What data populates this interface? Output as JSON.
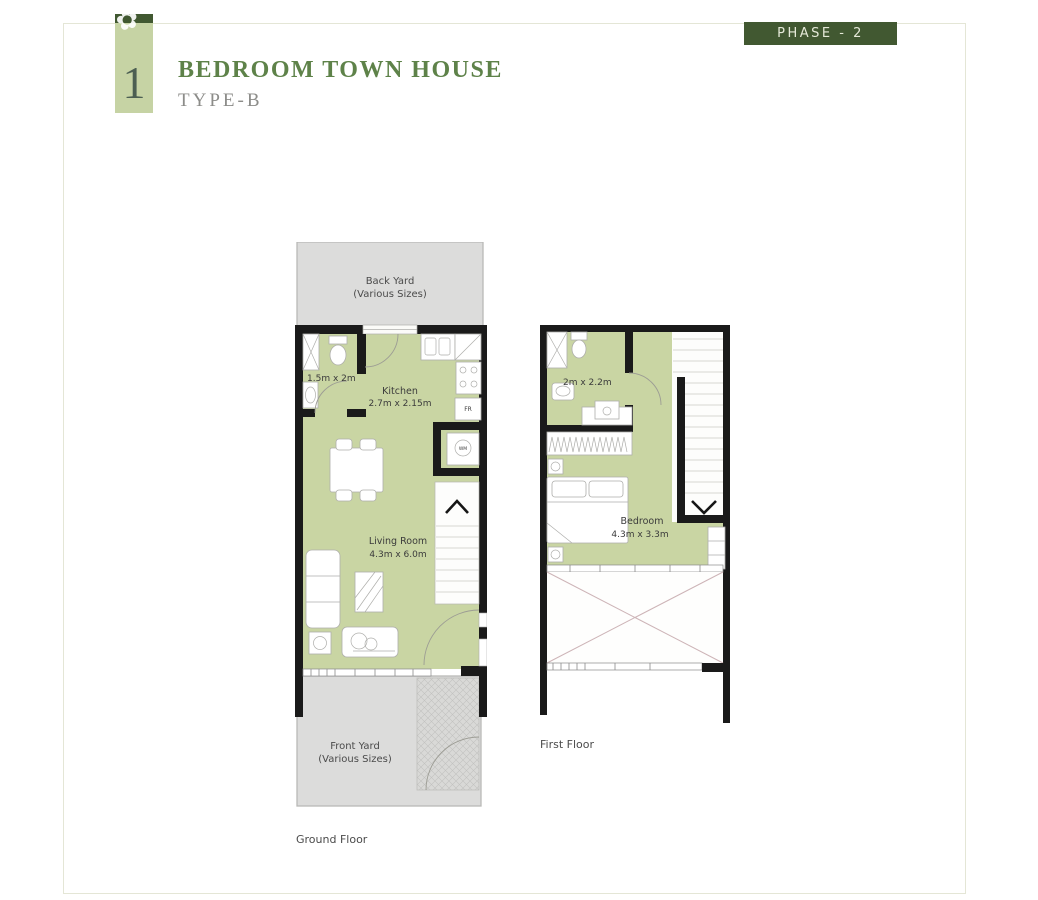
{
  "header": {
    "badge_number": "1",
    "title": "BEDROOM TOWN HOUSE",
    "subtitle": "TYPE-B",
    "phase_label": "PHASE - 2"
  },
  "ground_floor": {
    "caption": "Ground Floor",
    "back_yard_line1": "Back Yard",
    "back_yard_line2": "(Various Sizes)",
    "front_yard_line1": "Front Yard",
    "front_yard_line2": "(Various Sizes)",
    "bathroom_dim": "1.5m x 2m",
    "kitchen_name": "Kitchen",
    "kitchen_dim": "2.7m x 2.15m",
    "living_room_name": "Living Room",
    "living_room_dim": "4.3m x 6.0m",
    "fridge_label": "FR",
    "washer_label": "WM"
  },
  "first_floor": {
    "caption": "First Floor",
    "bathroom_dim": "2m x 2.2m",
    "bedroom_name": "Bedroom",
    "bedroom_dim": "4.3m x 3.3m"
  },
  "colors": {
    "accent_dark_green": "#415831",
    "badge_light_green": "#c6d3a4",
    "title_green": "#5e8249",
    "subtitle_gray": "#8c8c89",
    "floor_green": "#c9d5a3",
    "wall_black": "#1a1a1a",
    "yard_gray": "#dcdcdb",
    "phase_text": "#e5e9d8"
  }
}
